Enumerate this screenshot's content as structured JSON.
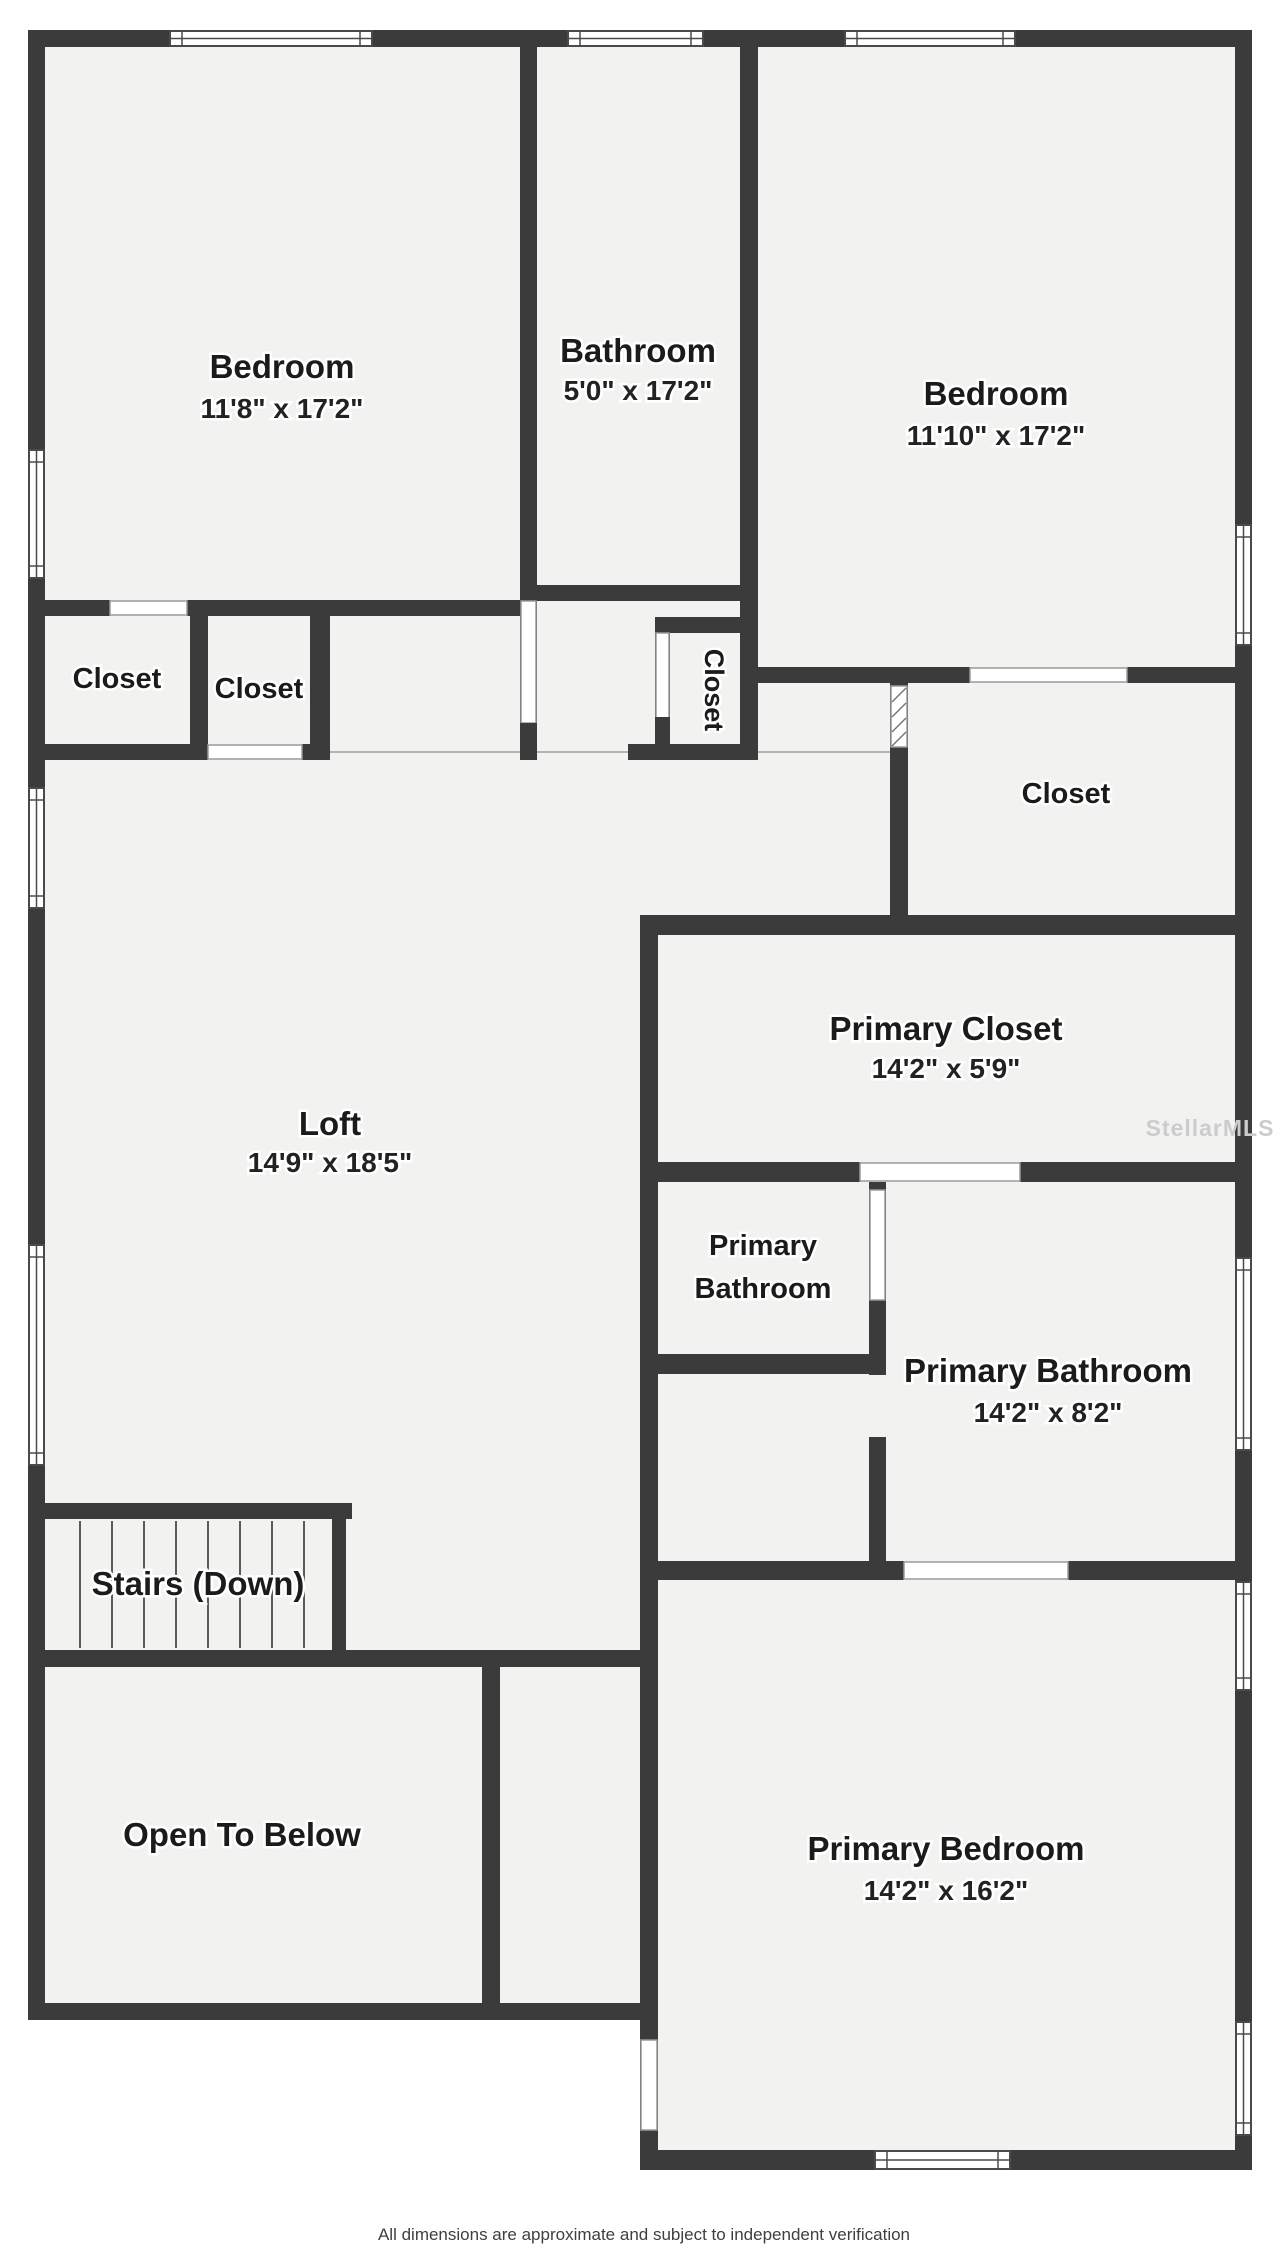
{
  "watermark": "StellarMLS",
  "disclaimer": "All dimensions are approximate and subject to independent verification",
  "colors": {
    "wall": "#3b3b3b",
    "floor": "#f2f2f1",
    "text": "#1b1b1b",
    "watermark": "#cccccc"
  },
  "rooms": [
    {
      "name": "Bedroom",
      "dims": "11'8\" x 17'2\""
    },
    {
      "name": "Bathroom",
      "dims": "5'0\" x 17'2\""
    },
    {
      "name": "Bedroom",
      "dims": "11'10\" x 17'2\""
    },
    {
      "name": "Closet"
    },
    {
      "name": "Closet"
    },
    {
      "name": "Closet"
    },
    {
      "name": "Closet"
    },
    {
      "name": "Primary Closet",
      "dims": "14'2\" x 5'9\""
    },
    {
      "name": "Primary Bathroom",
      "name_line1": "Primary",
      "name_line2": "Bathroom"
    },
    {
      "name": "Primary Bathroom",
      "dims": "14'2\" x 8'2\""
    },
    {
      "name": "Stairs (Down)"
    },
    {
      "name": "Open To Below"
    },
    {
      "name": "Primary Bedroom",
      "dims": "14'2\" x 16'2\""
    }
  ]
}
